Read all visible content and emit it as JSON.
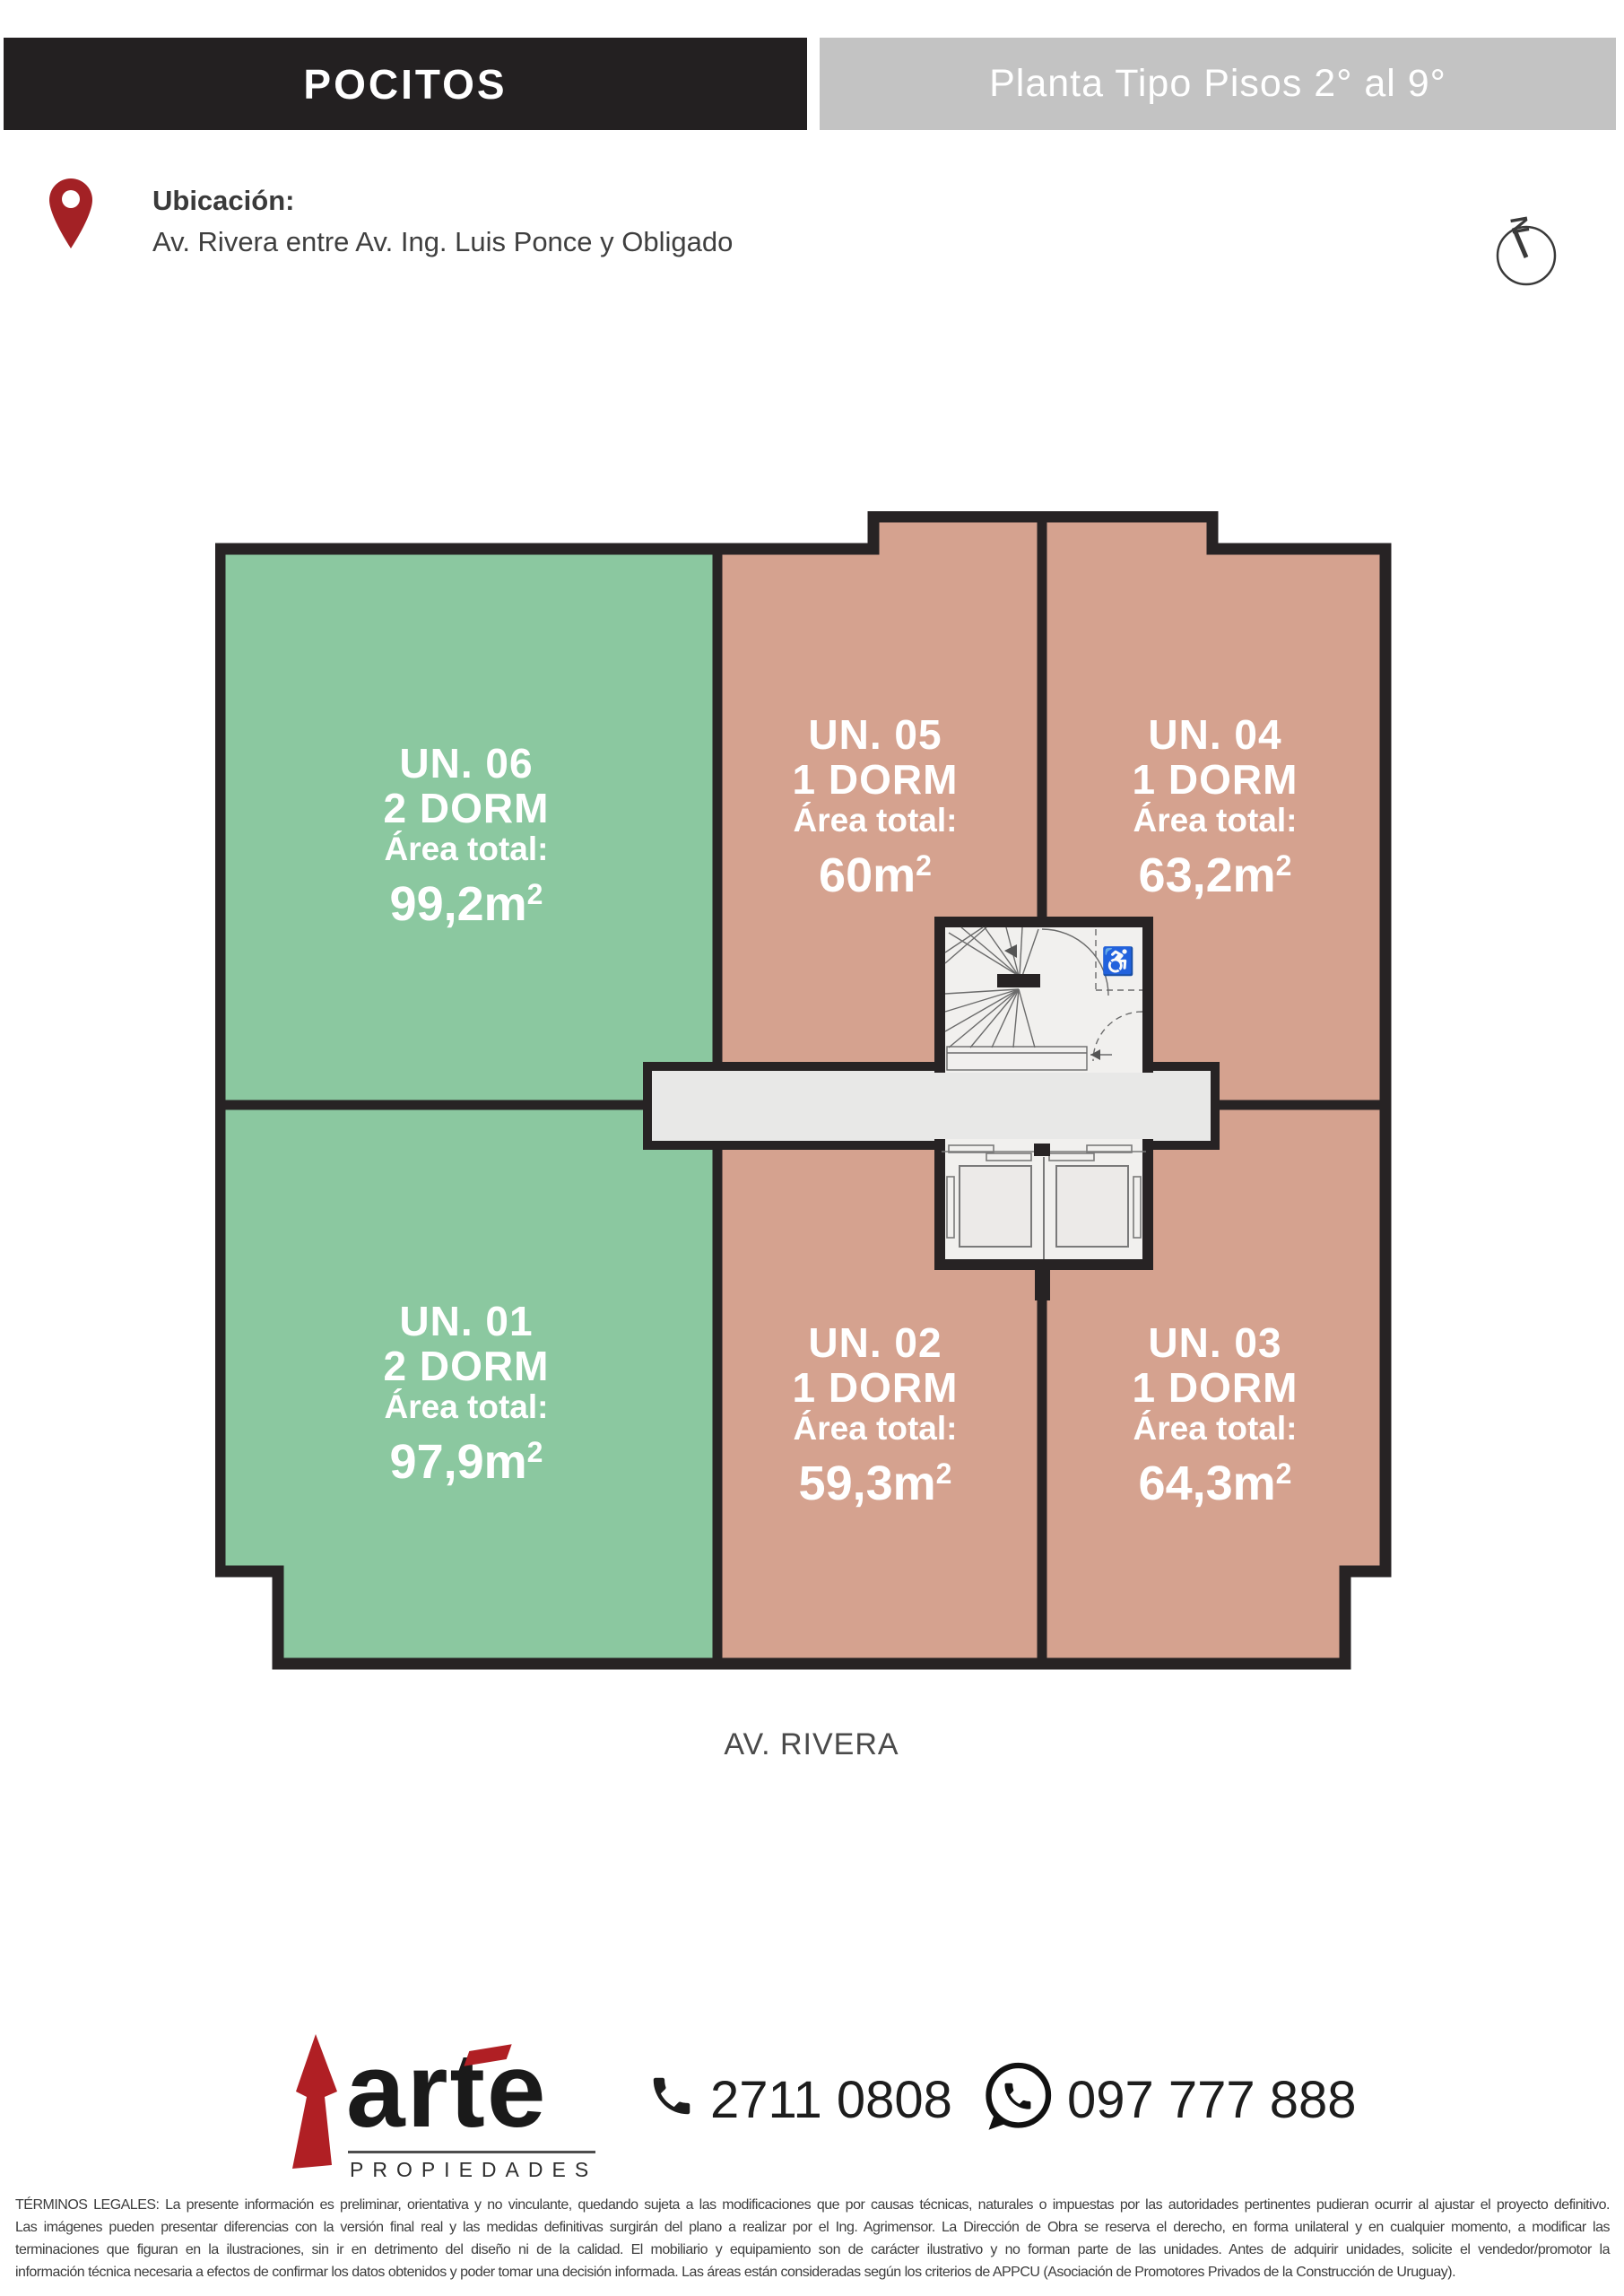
{
  "header": {
    "location_tag": "POCITOS",
    "plan_title": "Planta Tipo Pisos 2° al 9°"
  },
  "location": {
    "label": "Ubicación:",
    "address": "Av. Rivera entre Av. Ing. Luis Ponce y Obligado"
  },
  "compass": {
    "letter": "N"
  },
  "units": [
    {
      "id": "un-06",
      "name": "UN. 06",
      "dorms": "2 DORM",
      "area_label": "Área total:",
      "area_value": "99,2m",
      "area_sup": "2",
      "color": "green"
    },
    {
      "id": "un-05",
      "name": "UN. 05",
      "dorms": "1 DORM",
      "area_label": "Área total:",
      "area_value": "60m",
      "area_sup": "2",
      "color": "salmon"
    },
    {
      "id": "un-04",
      "name": "UN. 04",
      "dorms": "1 DORM",
      "area_label": "Área total:",
      "area_value": "63,2m",
      "area_sup": "2",
      "color": "salmon"
    },
    {
      "id": "un-01",
      "name": "UN. 01",
      "dorms": "2 DORM",
      "area_label": "Área total:",
      "area_value": "97,9m",
      "area_sup": "2",
      "color": "green"
    },
    {
      "id": "un-02",
      "name": "UN. 02",
      "dorms": "1 DORM",
      "area_label": "Área total:",
      "area_value": "59,3m",
      "area_sup": "2",
      "color": "salmon"
    },
    {
      "id": "un-03",
      "name": "UN. 03",
      "dorms": "1 DORM",
      "area_label": "Área total:",
      "area_value": "64,3m",
      "area_sup": "2",
      "color": "salmon"
    }
  ],
  "street_label": "AV. RIVERA",
  "footer": {
    "brand_name": "arte",
    "brand_sub": "PROPIEDADES",
    "phone": "2711 0808",
    "whatsapp": "097 777 888"
  },
  "icons": {
    "wheelchair": "♿"
  },
  "legal": {
    "line1": "TÉRMINOS LEGALES: La presente información es preliminar, orientativa y no vinculante, quedando sujeta a las modificaciones que por causas técnicas, naturales o impuestas por las autoridades pertinentes pudieran ocurrir al ajustar el proyecto definitivo.",
    "line2": "Las imágenes pueden presentar diferencias con la versión final real y las medidas definitivas surgirán del plano a realizar por el Ing. Agrimensor. La Dirección de Obra se reserva el derecho, en forma unilateral y en cualquier momento, a modificar las",
    "line3": "terminaciones que figuran en la ilustraciones, sin ir en detrimento del diseño ni de la calidad. El mobiliario y equipamiento son de carácter ilustrativo y no forman parte de las unidades. Antes de adquirir unidades, solicite el vendedor/promotor la",
    "line4": "información técnica necesaria a efectos de confirmar los datos obtenidos y poder tomar una decisión informada. Las áreas están consideradas según los criterios de APPCU (Asociación de Promotores Privados de la Construcción de Uruguay)."
  },
  "colors": {
    "unit_green": "#8bc8a0",
    "unit_salmon": "#d5a28f",
    "wall_black": "#272324",
    "corridor_gray": "#e8e8e7",
    "core_white": "#f1f0ee",
    "header_black": "#232021",
    "header_gray": "#c3c3c3",
    "pin_red": "#a32125",
    "brand_red": "#b01f24"
  }
}
